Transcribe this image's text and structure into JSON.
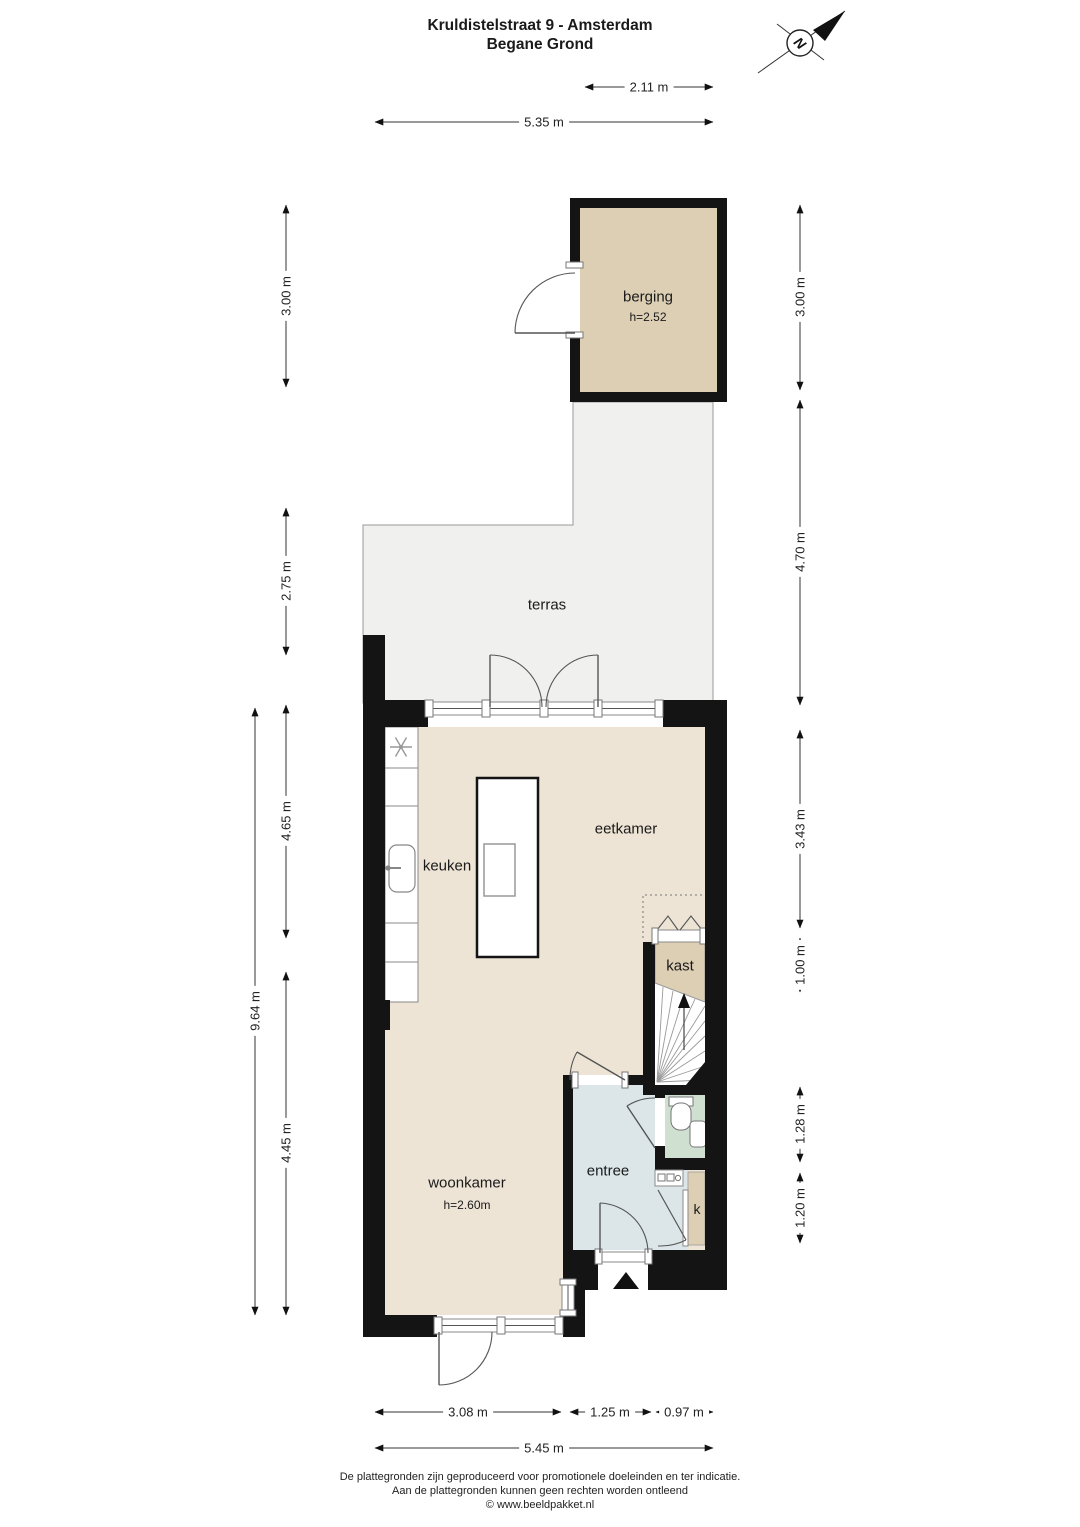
{
  "header": {
    "title_line1": "Kruldistelstraat 9 - Amsterdam",
    "title_line2": "Begane Grond"
  },
  "compass": {
    "letter": "N"
  },
  "rooms": {
    "berging": {
      "name": "berging",
      "height": "h=2.52"
    },
    "terras": {
      "name": "terras"
    },
    "eetkamer": {
      "name": "eetkamer"
    },
    "keuken": {
      "name": "keuken"
    },
    "kast": {
      "name": "kast"
    },
    "entree": {
      "name": "entree"
    },
    "woonkamer": {
      "name": "woonkamer",
      "height": "h=2.60m"
    },
    "k": {
      "name": "k"
    }
  },
  "dimensions": {
    "top": [
      "2.11 m",
      "5.35 m"
    ],
    "left": [
      "3.00 m",
      "2.75 m",
      "4.65 m",
      "9.64 m",
      "4.45 m"
    ],
    "right": [
      "3.00 m",
      "4.70 m",
      "3.43 m",
      "1.00 m",
      "1.28 m",
      "1.20 m"
    ],
    "bottom": [
      "3.08 m",
      "1.25 m",
      "0.97 m",
      "5.45 m"
    ]
  },
  "footer": {
    "line1": "De plattegronden zijn geproduceerd voor promotionele doeleinden en ter indicatie.",
    "line2": "Aan de plattegronden kunnen geen rechten worden ontleend",
    "line3": "© www.beeldpakket.nl"
  },
  "colors": {
    "wall": "#141414",
    "floor": "#EDE4D5",
    "storage": "#DCCFB4",
    "terrace": "#F0F0EF",
    "hall": "#DCE6E9",
    "toilet": "#CFE0D1"
  }
}
